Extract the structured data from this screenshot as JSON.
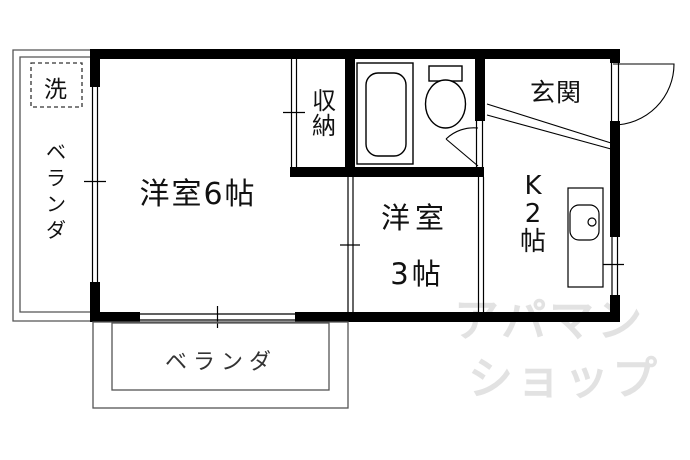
{
  "floorplan": {
    "labels": {
      "room6": "洋室6帖",
      "room3_line1": "洋室",
      "room3_line2": "3帖",
      "kitchen": "K2帖",
      "entrance": "玄関",
      "closet": "収納",
      "washer": "洗",
      "veranda_left": "ベランダ",
      "veranda_bottom": "ベランダ"
    },
    "watermark": {
      "line1": "アパマン",
      "line2": "ショップ",
      "color": "#e2e2e2"
    },
    "fixtures": [
      "bathtub-icon",
      "toilet-icon",
      "kitchen-sink-icon",
      "door-swing-icon",
      "window-icon",
      "washing-machine-space-icon"
    ],
    "colors": {
      "wall": "#000000",
      "line": "#000000",
      "veranda_line": "#555555",
      "background": "#ffffff",
      "text": "#111111"
    }
  }
}
